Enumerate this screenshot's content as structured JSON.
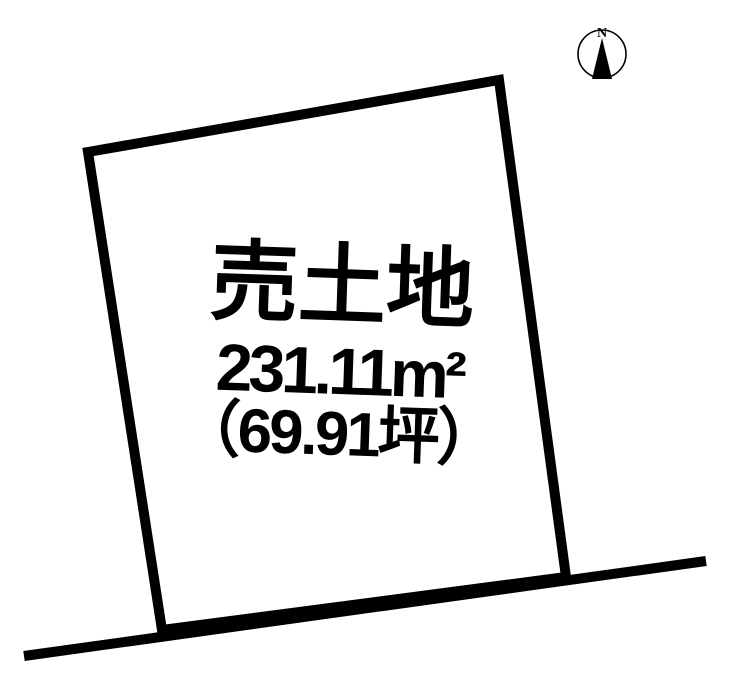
{
  "colors": {
    "ink": "#000000",
    "paper": "#ffffff"
  },
  "compass": {
    "north_label": "N"
  },
  "plot": {
    "title": "売土地",
    "area_m2_label": "231.11m²",
    "area_tsubo_label": "（69.91坪）"
  }
}
